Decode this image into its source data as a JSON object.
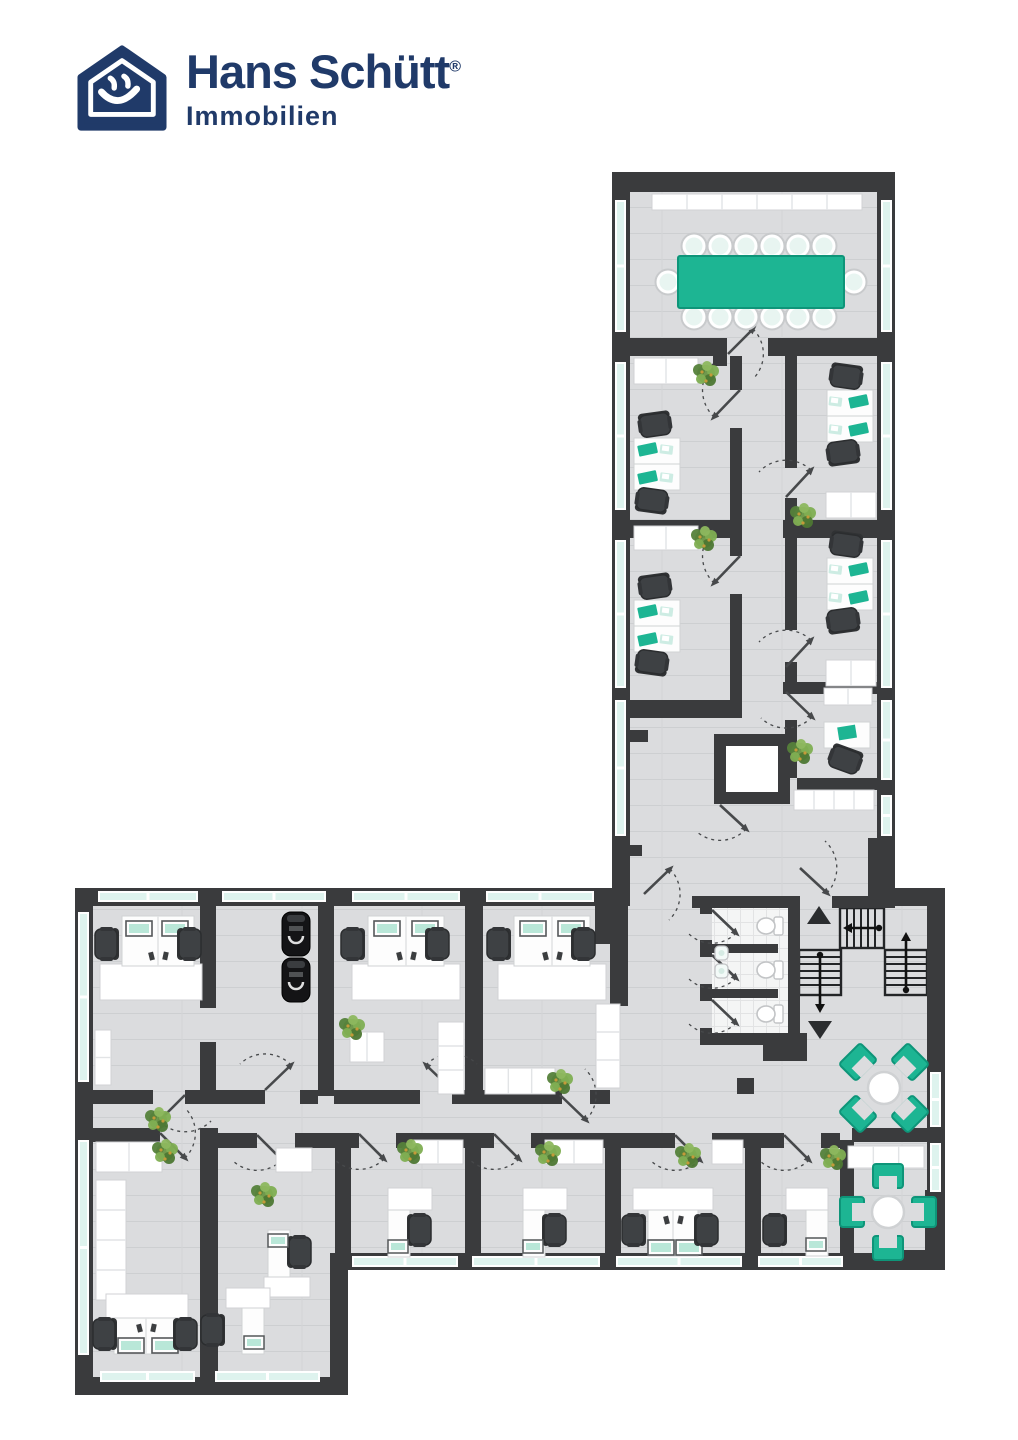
{
  "logo": {
    "brand": "Hans Schütt",
    "registered": "®",
    "subtitle": "Immobilien"
  },
  "palette": {
    "navy": "#203a69",
    "wall": "#3a3b3d",
    "floor": "#dbdcde",
    "floor_line": "#cdcfd1",
    "window": "#def3ee",
    "teal": "#1db593",
    "teal_dark": "#0e9579",
    "mint": "#cdece3",
    "chair": "#3e4144",
    "chair_edge": "#2b2d2f",
    "furniture_stroke": "#d0d2d4",
    "door": "#47494b"
  },
  "floorplan": {
    "floors": [
      [
        630,
        192,
        247,
        714
      ],
      [
        93,
        896,
        834,
        357
      ],
      [
        93,
        1253,
        237,
        124
      ]
    ],
    "tile": [
      712,
      906,
      76,
      127
    ],
    "shaft": {
      "outer": [
        714,
        734,
        76,
        70
      ],
      "inner": [
        726,
        746,
        52,
        46
      ]
    },
    "walls": [
      [
        612,
        172,
        283,
        20
      ],
      [
        612,
        172,
        18,
        716
      ],
      [
        877,
        172,
        18,
        733
      ],
      [
        630,
        338,
        96,
        18
      ],
      [
        768,
        338,
        109,
        18
      ],
      [
        713,
        338,
        14,
        28
      ],
      [
        730,
        356,
        12,
        34
      ],
      [
        730,
        428,
        12,
        128
      ],
      [
        730,
        594,
        12,
        106
      ],
      [
        785,
        356,
        12,
        112
      ],
      [
        785,
        498,
        12,
        132
      ],
      [
        785,
        662,
        12,
        30
      ],
      [
        785,
        720,
        12,
        58
      ],
      [
        630,
        520,
        112,
        18
      ],
      [
        630,
        700,
        112,
        18
      ],
      [
        783,
        520,
        94,
        18
      ],
      [
        783,
        682,
        94,
        12
      ],
      [
        797,
        778,
        80,
        12
      ],
      [
        612,
        730,
        36,
        12
      ],
      [
        612,
        845,
        30,
        11
      ],
      [
        868,
        838,
        27,
        67
      ],
      [
        612,
        888,
        18,
        18
      ],
      [
        75,
        888,
        537,
        18
      ],
      [
        75,
        888,
        18,
        507
      ],
      [
        75,
        1377,
        270,
        18
      ],
      [
        330,
        1270,
        18,
        125
      ],
      [
        330,
        1253,
        615,
        17
      ],
      [
        927,
        888,
        18,
        382
      ],
      [
        895,
        888,
        50,
        18
      ],
      [
        200,
        906,
        16,
        102
      ],
      [
        200,
        1042,
        16,
        48
      ],
      [
        318,
        906,
        16,
        190
      ],
      [
        465,
        906,
        18,
        190
      ],
      [
        595,
        906,
        33,
        38
      ],
      [
        610,
        944,
        18,
        62
      ],
      [
        93,
        1090,
        60,
        14
      ],
      [
        185,
        1090,
        80,
        14
      ],
      [
        300,
        1090,
        18,
        14
      ],
      [
        334,
        1090,
        86,
        14
      ],
      [
        452,
        1090,
        31,
        14
      ],
      [
        483,
        1090,
        79,
        14
      ],
      [
        590,
        1090,
        20,
        14
      ],
      [
        93,
        1128,
        67,
        14
      ],
      [
        200,
        1128,
        18,
        267
      ],
      [
        218,
        1133,
        39,
        15
      ],
      [
        295,
        1133,
        40,
        15
      ],
      [
        335,
        1133,
        16,
        137
      ],
      [
        465,
        1133,
        16,
        137
      ],
      [
        605,
        1133,
        16,
        137
      ],
      [
        745,
        1133,
        16,
        137
      ],
      [
        840,
        1140,
        14,
        113
      ],
      [
        351,
        1133,
        8,
        15
      ],
      [
        396,
        1133,
        69,
        15
      ],
      [
        481,
        1133,
        13,
        15
      ],
      [
        531,
        1133,
        74,
        15
      ],
      [
        621,
        1133,
        54,
        15
      ],
      [
        712,
        1133,
        33,
        15
      ],
      [
        761,
        1133,
        23,
        15
      ],
      [
        821,
        1133,
        19,
        15
      ],
      [
        852,
        1128,
        75,
        14
      ],
      [
        692,
        896,
        108,
        12
      ],
      [
        832,
        896,
        63,
        12
      ],
      [
        700,
        906,
        12,
        8
      ],
      [
        700,
        940,
        12,
        17
      ],
      [
        700,
        984,
        12,
        17
      ],
      [
        700,
        1028,
        12,
        17
      ],
      [
        712,
        944,
        66,
        9
      ],
      [
        712,
        989,
        66,
        9
      ],
      [
        788,
        906,
        12,
        139
      ],
      [
        700,
        1033,
        92,
        12
      ],
      [
        763,
        1033,
        44,
        28
      ],
      [
        925,
        1190,
        20,
        63
      ],
      [
        883,
        1250,
        62,
        20
      ]
    ],
    "pillars": [
      [
        737,
        1078,
        17,
        16
      ]
    ],
    "windows": [
      [
        615,
        200,
        11,
        132
      ],
      [
        615,
        362,
        11,
        148
      ],
      [
        615,
        540,
        11,
        148
      ],
      [
        615,
        700,
        11,
        136
      ],
      [
        881,
        200,
        11,
        132
      ],
      [
        881,
        362,
        11,
        148
      ],
      [
        881,
        540,
        11,
        148
      ],
      [
        881,
        700,
        11,
        80
      ],
      [
        881,
        795,
        11,
        41
      ],
      [
        98,
        891,
        100,
        11
      ],
      [
        222,
        891,
        104,
        11
      ],
      [
        352,
        891,
        108,
        11
      ],
      [
        486,
        891,
        108,
        11
      ],
      [
        78,
        912,
        11,
        170
      ],
      [
        78,
        1140,
        11,
        215
      ],
      [
        100,
        1371,
        95,
        11
      ],
      [
        215,
        1371,
        105,
        11
      ],
      [
        352,
        1256,
        106,
        11
      ],
      [
        472,
        1256,
        128,
        11
      ],
      [
        616,
        1256,
        126,
        11
      ],
      [
        758,
        1256,
        85,
        11
      ],
      [
        930,
        1072,
        11,
        55
      ],
      [
        930,
        1143,
        11,
        49
      ]
    ],
    "stairs": [
      {
        "r": [
          840,
          908,
          44,
          40
        ],
        "dir": "h",
        "arrow": "left"
      },
      {
        "r": [
          799,
          950,
          42,
          45
        ],
        "dir": "v",
        "arrow": "down"
      },
      {
        "r": [
          885,
          950,
          42,
          45
        ],
        "dir": "v",
        "arrow": "up"
      }
    ],
    "triangles": [
      {
        "cx": 819,
        "cy": 915,
        "dir": "up"
      },
      {
        "cx": 820,
        "cy": 1030,
        "dir": "down"
      }
    ],
    "doors": [
      {
        "h": [
          728,
          354
        ],
        "e": [
          753,
          329
        ],
        "s": 1
      },
      {
        "h": [
          740,
          390
        ],
        "e": [
          714,
          417
        ],
        "s": 1
      },
      {
        "h": [
          740,
          556
        ],
        "e": [
          714,
          583
        ],
        "s": 1
      },
      {
        "h": [
          786,
          497
        ],
        "e": [
          811,
          470
        ],
        "s": 0
      },
      {
        "h": [
          786,
          667
        ],
        "e": [
          811,
          640
        ],
        "s": 0
      },
      {
        "h": [
          786,
          692
        ],
        "e": [
          812,
          717
        ],
        "s": 1
      },
      {
        "h": [
          800,
          868
        ],
        "e": [
          827,
          893
        ],
        "s": 0
      },
      {
        "h": [
          644,
          894
        ],
        "e": [
          670,
          869
        ],
        "s": 1
      },
      {
        "h": [
          712,
          910
        ],
        "e": [
          736,
          933
        ],
        "s": 1
      },
      {
        "h": [
          712,
          955
        ],
        "e": [
          736,
          978
        ],
        "s": 1
      },
      {
        "h": [
          712,
          1000
        ],
        "e": [
          736,
          1023
        ],
        "s": 1
      },
      {
        "h": [
          185,
          1095
        ],
        "e": [
          159,
          1121
        ],
        "s": 0
      },
      {
        "h": [
          265,
          1090
        ],
        "e": [
          291,
          1065
        ],
        "s": 0
      },
      {
        "h": [
          452,
          1090
        ],
        "e": [
          426,
          1065
        ],
        "s": 1
      },
      {
        "h": [
          560,
          1095
        ],
        "e": [
          586,
          1120
        ],
        "s": 0
      },
      {
        "h": [
          160,
          1133
        ],
        "e": [
          185,
          1158
        ],
        "s": 0
      },
      {
        "h": [
          257,
          1135
        ],
        "e": [
          282,
          1160
        ],
        "s": 1
      },
      {
        "h": [
          359,
          1134
        ],
        "e": [
          384,
          1159
        ],
        "s": 1
      },
      {
        "h": [
          494,
          1134
        ],
        "e": [
          519,
          1159
        ],
        "s": 1
      },
      {
        "h": [
          675,
          1135
        ],
        "e": [
          700,
          1160
        ],
        "s": 1
      },
      {
        "h": [
          784,
          1135
        ],
        "e": [
          809,
          1160
        ],
        "s": 1
      },
      {
        "h": [
          720,
          805
        ],
        "e": [
          746,
          829
        ],
        "s": 1
      }
    ],
    "conference": {
      "table": [
        678,
        256,
        166,
        52
      ],
      "top_cx": [
        694,
        720,
        746,
        772,
        798,
        824
      ],
      "top_cy": 246,
      "bot_cy": 317,
      "ends": [
        [
          668,
          282
        ],
        [
          854,
          282
        ]
      ]
    },
    "sideboards": [
      [
        652,
        194,
        210,
        16,
        6
      ],
      [
        634,
        358,
        64,
        26,
        2
      ],
      [
        634,
        526,
        64,
        24,
        2
      ],
      [
        826,
        492,
        50,
        26,
        2
      ],
      [
        826,
        660,
        50,
        26,
        2
      ],
      [
        824,
        688,
        48,
        17,
        2
      ],
      [
        794,
        790,
        80,
        20,
        4
      ],
      [
        95,
        1030,
        16,
        55,
        2
      ],
      [
        350,
        1032,
        34,
        30,
        2
      ],
      [
        438,
        1022,
        26,
        72,
        3
      ],
      [
        485,
        1068,
        70,
        26,
        3
      ],
      [
        596,
        1004,
        24,
        84,
        3
      ],
      [
        96,
        1142,
        66,
        30,
        2
      ],
      [
        96,
        1180,
        30,
        120,
        4
      ],
      [
        276,
        1148,
        36,
        24,
        1
      ],
      [
        413,
        1140,
        50,
        24,
        2
      ],
      [
        545,
        1140,
        58,
        24,
        2
      ],
      [
        712,
        1140,
        31,
        24,
        1
      ],
      [
        848,
        1146,
        76,
        22,
        3
      ]
    ],
    "plants": [
      [
        706,
        374
      ],
      [
        704,
        539
      ],
      [
        803,
        516
      ],
      [
        800,
        752
      ],
      [
        352,
        1028
      ],
      [
        560,
        1082
      ],
      [
        688,
        1156
      ],
      [
        833,
        1158
      ],
      [
        158,
        1120
      ],
      [
        165,
        1152
      ],
      [
        264,
        1195
      ],
      [
        410,
        1152
      ],
      [
        548,
        1154
      ]
    ],
    "vdesks": [
      {
        "x": 634,
        "y": 438,
        "side": "l",
        "c1": [
          655,
          425
        ],
        "c2": [
          652,
          500
        ]
      },
      {
        "x": 634,
        "y": 600,
        "side": "l",
        "c1": [
          655,
          587
        ],
        "c2": [
          652,
          662
        ]
      },
      {
        "x": 827,
        "y": 390,
        "side": "r",
        "c1": [
          846,
          377
        ],
        "c2": [
          843,
          452
        ]
      },
      {
        "x": 827,
        "y": 558,
        "side": "r",
        "c1": [
          846,
          545
        ],
        "c2": [
          843,
          620
        ]
      }
    ],
    "hdesks": [
      {
        "dir": "up",
        "desks": [
          122,
          916,
          72,
          50
        ],
        "mons": [
          [
            126,
            921
          ],
          [
            162,
            921
          ]
        ],
        "chairs": [
          [
            106,
            944,
            90
          ],
          [
            190,
            944,
            -90
          ]
        ],
        "table": [
          100,
          964,
          102,
          36
        ]
      },
      {
        "dir": "up",
        "desks": [
          368,
          916,
          76,
          50
        ],
        "mons": [
          [
            374,
            921
          ],
          [
            412,
            921
          ]
        ],
        "chairs": [
          [
            352,
            944,
            90
          ],
          [
            438,
            944,
            -90
          ]
        ],
        "table": [
          352,
          964,
          108,
          36
        ]
      },
      {
        "dir": "up",
        "desks": [
          514,
          916,
          76,
          50
        ],
        "mons": [
          [
            520,
            921
          ],
          [
            558,
            921
          ]
        ],
        "chairs": [
          [
            498,
            944,
            90
          ],
          [
            584,
            944,
            -90
          ]
        ],
        "table": [
          498,
          964,
          108,
          36
        ]
      },
      {
        "dir": "down",
        "desks": [
          114,
          1318,
          64,
          36
        ],
        "mons": [
          [
            118,
            1338
          ],
          [
            152,
            1338
          ]
        ],
        "chairs": [
          [
            104,
            1334,
            90
          ],
          [
            186,
            1334,
            -90
          ]
        ],
        "table": [
          106,
          1294,
          82,
          24
        ]
      },
      {
        "dir": "down",
        "desks": [
          648,
          1210,
          50,
          46
        ],
        "mons": [
          [
            648,
            1240
          ],
          [
            676,
            1240
          ]
        ],
        "chairs": [
          [
            633,
            1230,
            90
          ],
          [
            707,
            1230,
            -90
          ]
        ],
        "table": [
          633,
          1188,
          80,
          22
        ]
      }
    ],
    "singledesks": [
      {
        "table": [
          388,
          1188,
          44,
          22
        ],
        "desk": [
          388,
          1210,
          22,
          47
        ],
        "chair": [
          420,
          1230,
          -90
        ],
        "mon": [
          388,
          1240
        ]
      },
      {
        "table": [
          523,
          1188,
          44,
          22
        ],
        "desk": [
          523,
          1210,
          22,
          47
        ],
        "chair": [
          555,
          1230,
          -90
        ],
        "mon": [
          523,
          1240
        ]
      },
      {
        "table": [
          786,
          1188,
          42,
          22
        ],
        "desk": [
          806,
          1210,
          22,
          46
        ],
        "chair": [
          774,
          1230,
          90
        ],
        "mon": [
          806,
          1238
        ]
      },
      {
        "table": [
          264,
          1277,
          46,
          20
        ],
        "desk": [
          268,
          1230,
          22,
          47
        ],
        "chair": [
          300,
          1252,
          -90
        ],
        "mon": [
          268,
          1234
        ]
      },
      {
        "table": [
          226,
          1288,
          44,
          20
        ],
        "desk": [
          242,
          1308,
          22,
          46
        ],
        "chair": [
          212,
          1330,
          90
        ],
        "mon": [
          244,
          1336
        ]
      }
    ],
    "laptop_desk": {
      "desk": [
        824,
        722,
        46,
        26
      ],
      "pad": [
        838,
        726
      ],
      "chair": [
        845,
        760,
        20
      ]
    },
    "blackchairs": [
      [
        296,
        912
      ],
      [
        296,
        958
      ]
    ],
    "lounges": [
      {
        "cx": 884,
        "cy": 1088,
        "kind": "diamond"
      },
      {
        "cx": 888,
        "cy": 1212,
        "kind": "plus"
      }
    ],
    "toilets": [
      [
        769,
        926
      ],
      [
        769,
        970
      ],
      [
        769,
        1014
      ]
    ],
    "sinks": [
      [
        715,
        946
      ],
      [
        715,
        964
      ]
    ]
  }
}
